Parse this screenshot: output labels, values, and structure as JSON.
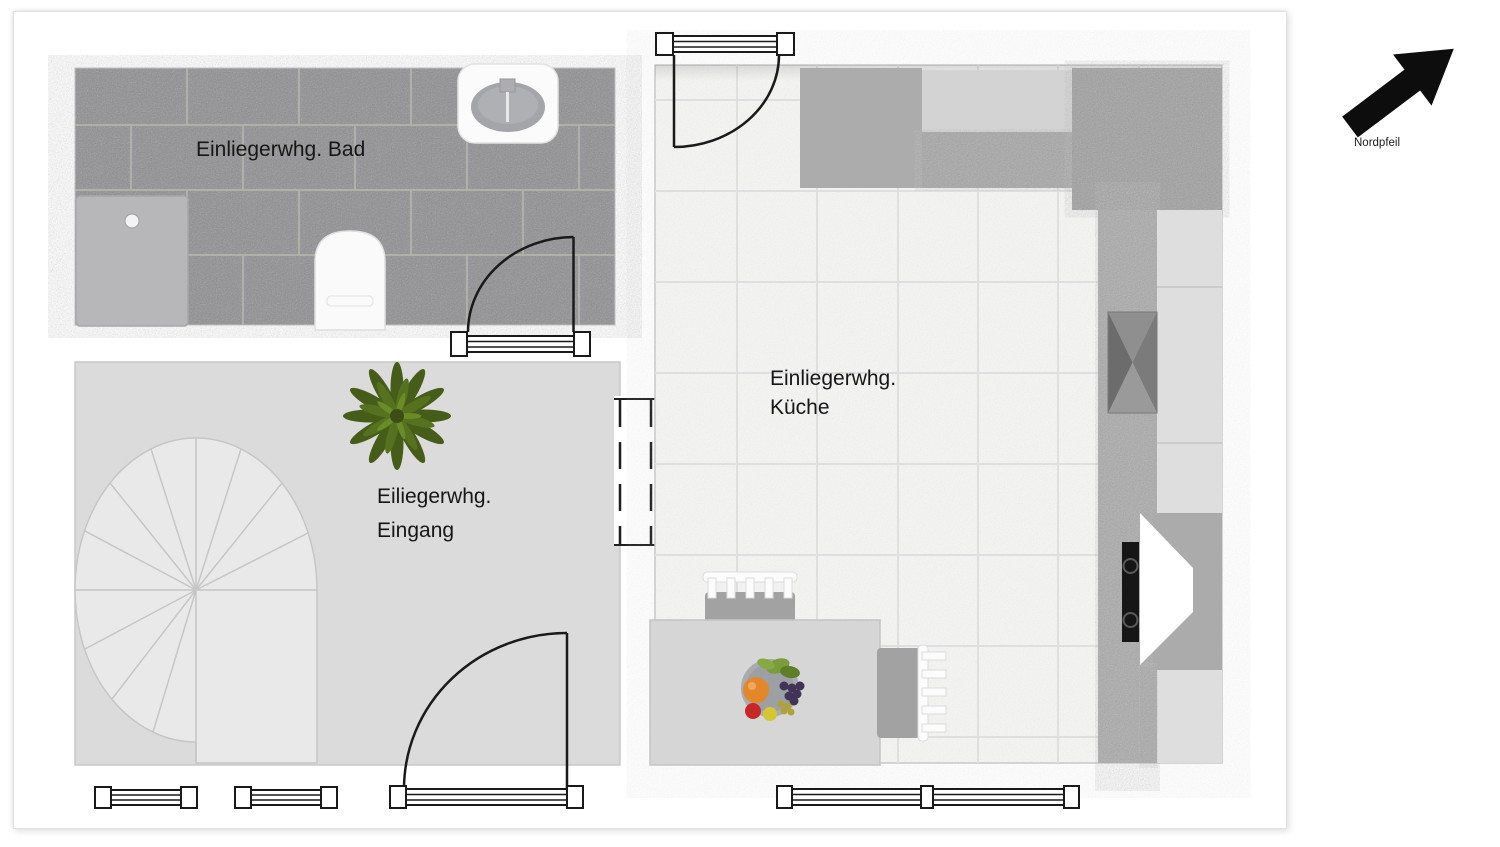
{
  "floor_plan": {
    "type": "apartment-floor-plan",
    "rooms": {
      "bathroom": {
        "label": "Einliegerwhg. Bad",
        "floor": "dark-gray-stone-tiles",
        "fixtures": [
          "washbasin",
          "shower-tray",
          "toilet",
          "swing-door"
        ]
      },
      "entrance": {
        "label_line1": "Eiliegerwhg.",
        "label_line2": "Eingang",
        "floor": "plain-light-gray",
        "fixtures": [
          "spiral-staircase",
          "potted-plant",
          "swing-door",
          "wall-opening"
        ]
      },
      "kitchen": {
        "label_line1": "Einliegerwhg.",
        "label_line2": "Küche",
        "floor": "white-speckled-tiles",
        "fixtures": [
          "swing-door",
          "kitchen-counters",
          "kitchen-sink",
          "cooktop-stove",
          "dining-table",
          "two-chairs",
          "fruit-bowl",
          "double-window"
        ]
      }
    },
    "north_arrow": {
      "label": "Nordpfeil",
      "direction": "north-east"
    },
    "exterior": {
      "windows_bottom_left": 2,
      "windows_bottom_kitchen": "double"
    },
    "colors": {
      "bathroom_tile": "#8E8E91",
      "grout": "#B5B5AA",
      "entrance_floor": "#DBDBDB",
      "kitchen_floor": "#F6F6F5",
      "kitchen_grid": "#DFDFDF",
      "counter_dark": "#A0A0A0",
      "counter_speckle": "#A6A6A6",
      "cabinet_light": "#DEDEDE",
      "appliance_gray": "#ACACAC",
      "table_gray": "#D6D6D6",
      "chair_gray": "#A2A2A2",
      "shower_gray": "#B7B7BA",
      "line_black": "#1A1A1A",
      "plant_dark": "#465D1A",
      "plant_mid": "#57721F",
      "plant_light": "#6B8A28",
      "arrow_black": "#0D0D0D"
    }
  }
}
